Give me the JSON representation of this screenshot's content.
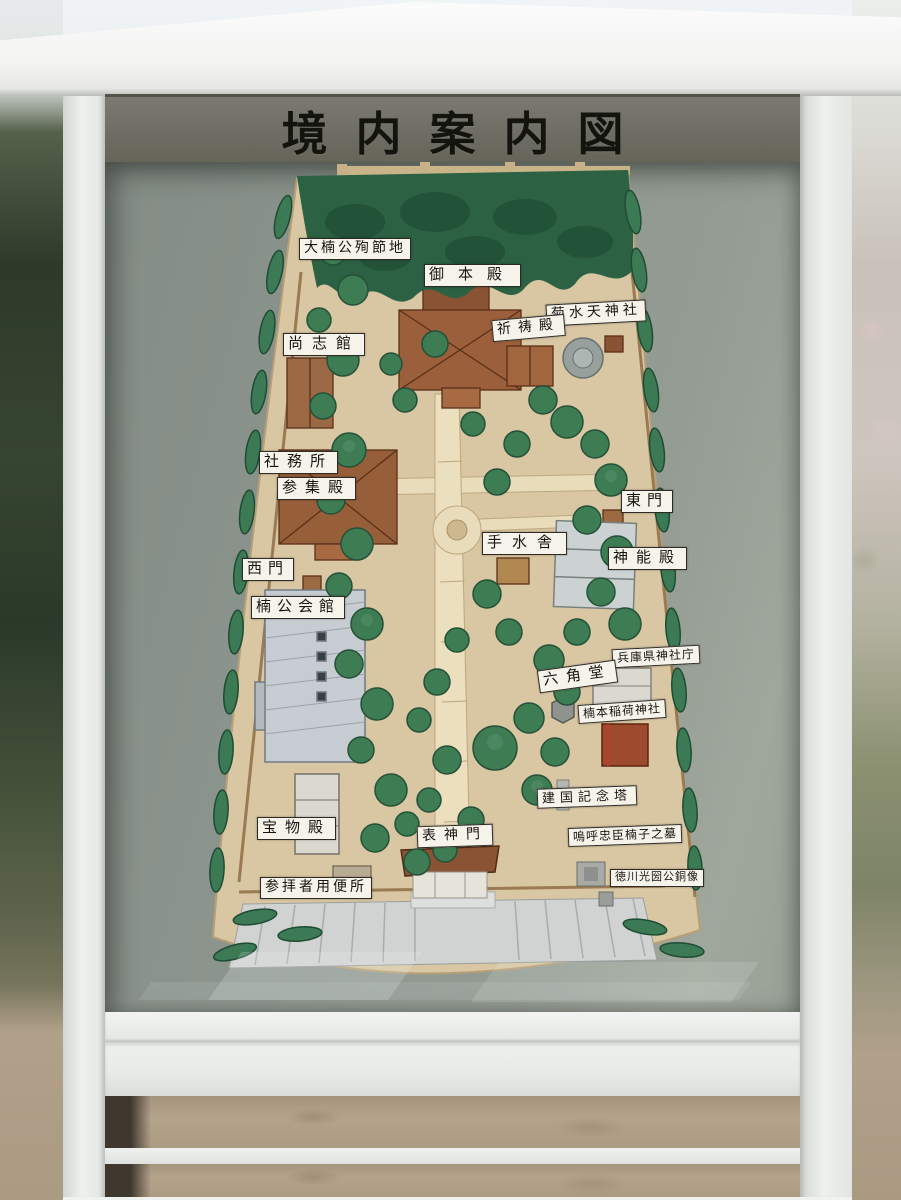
{
  "sign": {
    "title": "境内案内図"
  },
  "map": {
    "labels": [
      {
        "text": "大楠公殉節地"
      },
      {
        "text": "御本殿"
      },
      {
        "text": "菊水天神社"
      },
      {
        "text": "祈祷殿"
      },
      {
        "text": "尚志館"
      },
      {
        "text": "社務所"
      },
      {
        "text": "参集殿"
      },
      {
        "text": "東門"
      },
      {
        "text": "手水舎"
      },
      {
        "text": "神能殿"
      },
      {
        "text": "西門"
      },
      {
        "text": "楠公会館"
      },
      {
        "text": "兵庫県神社庁"
      },
      {
        "text": "六角堂"
      },
      {
        "text": "楠本稲荷神社"
      },
      {
        "text": "建国記念塔"
      },
      {
        "text": "宝物殿"
      },
      {
        "text": "表神門"
      },
      {
        "text": "嗚呼忠臣楠子之墓"
      },
      {
        "text": "徳川光圀公銅像"
      },
      {
        "text": "参拝者用便所"
      }
    ]
  },
  "colors": {
    "title_band": "#6e6d63",
    "glass": "#8d968e",
    "map_paper": "#d9c6a2",
    "tree_green": "#3e7c54",
    "roof_brown": "#9c5f3b",
    "frame_white": "#eef0ed"
  }
}
